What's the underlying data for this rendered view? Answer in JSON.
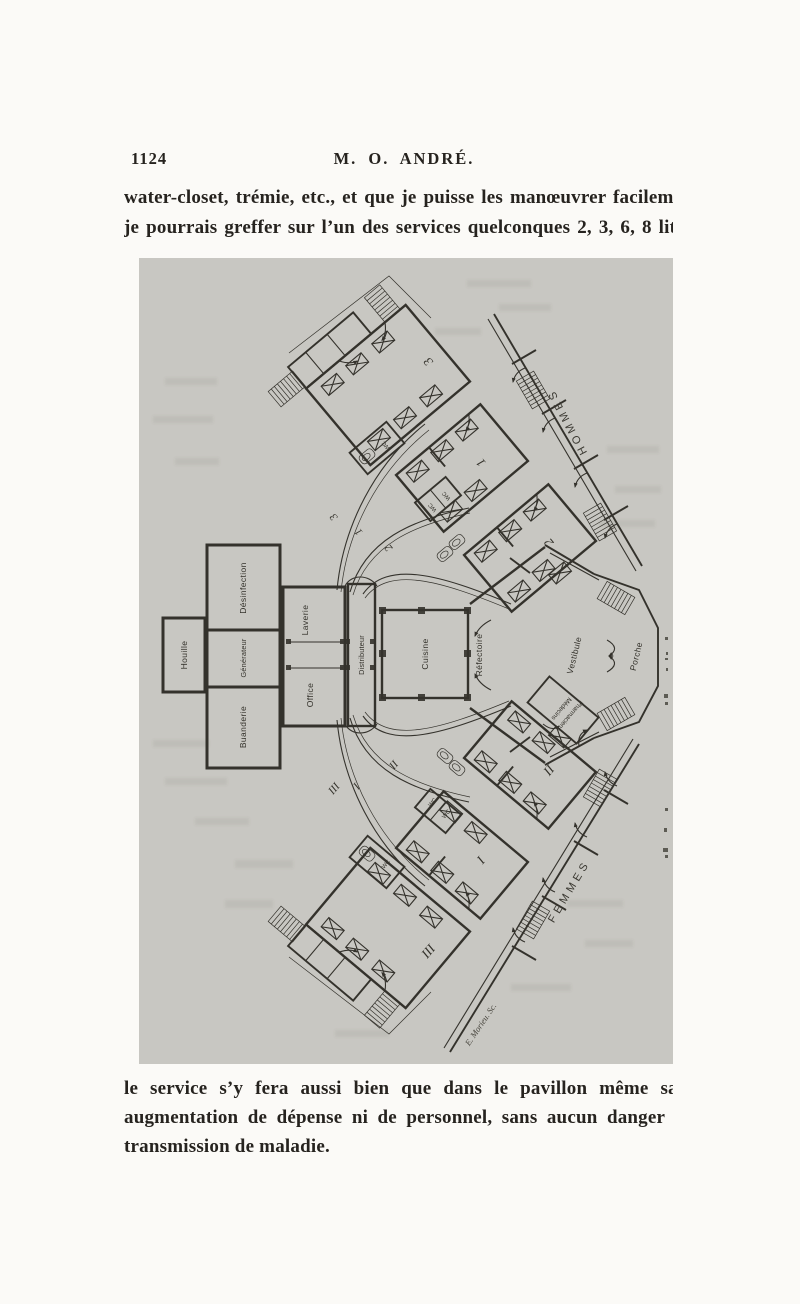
{
  "page": {
    "number": "1124",
    "running_head": "M. O. ANDRÉ."
  },
  "top_paragraph": {
    "line1": "water-closet, trémie, etc., et que je puisse les manœuvrer facilem",
    "line2": "je pourrais greffer sur l’un des services quelconques 2, 3, 6, 8 lit"
  },
  "bottom_paragraph": {
    "line1": "le service s’y fera aussi bien que dans le pavillon même sa",
    "line2": "augmentation de dépense ni de personnel, sans aucun danger",
    "line3": "transmission de maladie."
  },
  "plan": {
    "wings": {
      "men": "HOMMES",
      "women": "FEMMES"
    },
    "rooms": {
      "houille": "Houille",
      "desinfection": "Désinfection",
      "generateur": "Générateur",
      "buanderie": "Buanderie",
      "laverie": "Laverie",
      "office": "Office",
      "distributeur": "Distributeur",
      "cuisine": "Cuisine",
      "refectoire": "Réfectoire",
      "vestibule": "Vestibule",
      "porche": "Porche",
      "medecins": "Médecins",
      "pharmaciens": "Pharmaciens",
      "wc": "WC"
    },
    "ward_numbers": {
      "men": [
        "3",
        "1",
        "2"
      ],
      "women": [
        "III",
        "I",
        "II"
      ]
    },
    "corridor_numbers": {
      "men": [
        "3",
        "1",
        "2"
      ],
      "women": [
        "III",
        "I",
        "II"
      ]
    },
    "engraver_signature": "E. Morieu. Sc."
  },
  "colors": {
    "paper": "#fbfaf7",
    "scan_background": "#c8c7c2",
    "plan_ink": "#34322c",
    "text_ink": "#26231f"
  }
}
